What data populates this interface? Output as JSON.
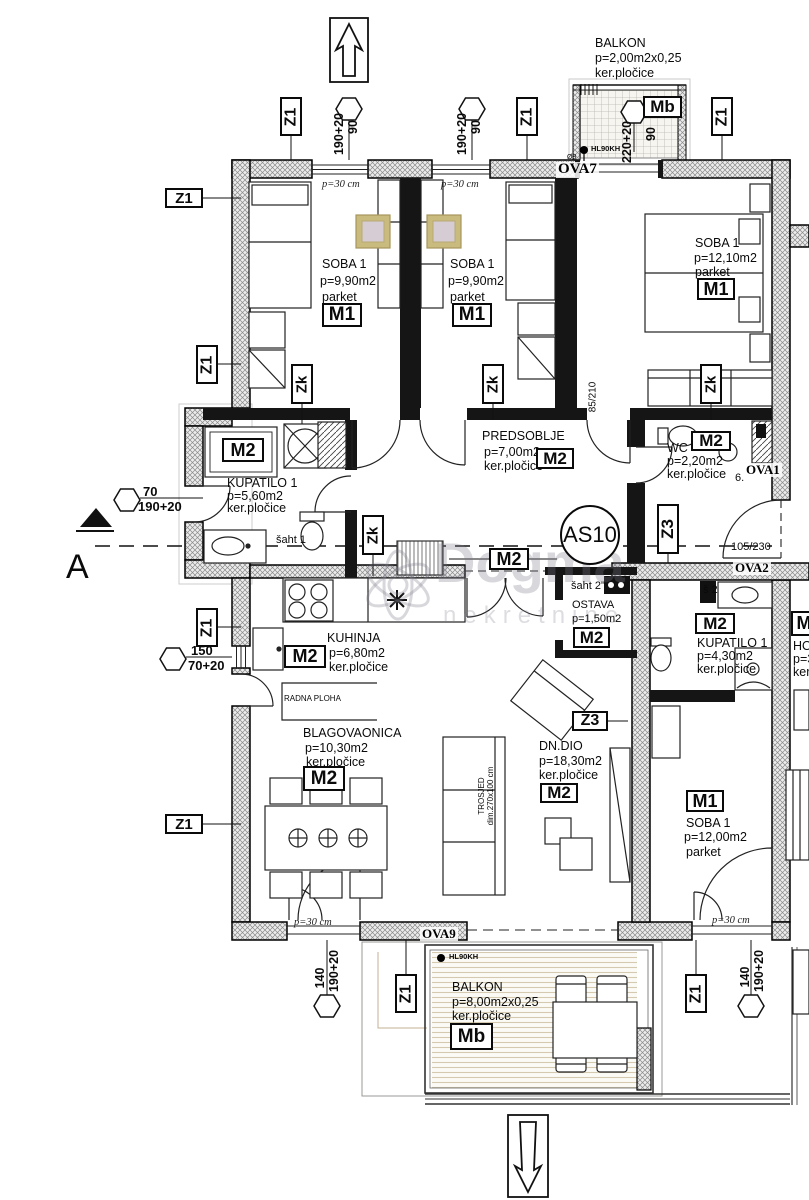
{
  "unit": {
    "code": "AS10"
  },
  "watermark": {
    "line1": "Dogma",
    "line2": "nekretnine"
  },
  "markers": {
    "z1": "Z1",
    "zk": "Zk",
    "z3": "Z3",
    "m2": "M2",
    "section": "A",
    "m_partial": "M"
  },
  "rooms": {
    "soba_tl": {
      "name": "SOBA 1",
      "area": "p=9,90m2",
      "floor": "parket",
      "material": "M1"
    },
    "soba_tc": {
      "name": "SOBA 1",
      "area": "p=9,90m2",
      "floor": "parket",
      "material": "M1"
    },
    "soba_tr": {
      "name": "SOBA 1",
      "area": "p=12,10m2",
      "floor": "parket",
      "material": "M1"
    },
    "predsoblje": {
      "name": "PREDSOBLJE",
      "area": "p=7,00m2",
      "floor": "ker.pločice",
      "material": "M2"
    },
    "wc": {
      "name": "WC",
      "area": "p=2,20m2",
      "floor": "ker.pločice",
      "material": "M2"
    },
    "kupatilo_left": {
      "name": "KUPATILO 1",
      "area": "p=5,60m2",
      "floor": "ker.pločice",
      "material": "M2"
    },
    "kuhinja": {
      "name": "KUHINJA",
      "area": "p=6,80m2",
      "floor": "ker.pločice",
      "material": "M2"
    },
    "blagovaonica": {
      "name": "BLAGOVAONICA",
      "area": "p=10,30m2",
      "floor": "ker.pločice",
      "material": "M2"
    },
    "dn_dio": {
      "name": "DN.DIO",
      "area": "p=18,30m2",
      "floor": "ker.pločice",
      "material": "M2"
    },
    "ostava": {
      "name": "OSTAVA",
      "area": "p=1,50m2",
      "material": "M2"
    },
    "kupatilo_right": {
      "name": "KUPATILO 1",
      "area": "p=4,30m2",
      "floor": "ker.pločice",
      "material": "M2"
    },
    "soba_br": {
      "name": "SOBA 1",
      "area": "p=12,00m2",
      "floor": "parket",
      "material": "M1"
    },
    "balkon_top": {
      "name": "BALKON",
      "area": "p=2,00m2x0,25",
      "floor": "ker.pločice",
      "material": "Mb"
    },
    "balkon_bottom": {
      "name": "BALKON",
      "area": "p=8,00m2x0,25",
      "floor": "ker.pločice",
      "material": "Mb"
    }
  },
  "dims": {
    "win_tl": {
      "a": "190+20",
      "b": "90"
    },
    "win_tc": {
      "a": "190+20",
      "b": "90"
    },
    "balc_door": {
      "a": "220+20",
      "b": "90"
    },
    "bath_door": {
      "a": "70",
      "b": "190+20"
    },
    "kitchen_win": {
      "a": "150",
      "b": "70+20"
    },
    "terrace_door_l": {
      "a": "140",
      "b": "190+20"
    },
    "terrace_door_r": {
      "a": "140",
      "b": "190+20"
    },
    "door105": "105/230",
    "door85": "85/210",
    "p30": "p=30 cm"
  },
  "openings": {
    "ova7": "OVA7",
    "ova1": "OVA1",
    "ova2": "OVA2",
    "ova9": "OVA9",
    "n6": "6.",
    "hl": "HL90KH",
    "fi8": "Ø8"
  },
  "annots": {
    "saht1": "šaht 1",
    "saht2": "šaht 2\"",
    "s2": "š 2",
    "radna": "RADNA PLOHA",
    "trosjed1": "TROSJED",
    "trosjed2": "dim.270x100 cm"
  },
  "neighbor": {
    "ho": "HO",
    "p3": "p=3",
    "ker": "ker"
  },
  "colors": {
    "pillow_accent": "#c9ba7e",
    "balcony_stripe": "#d5cab0",
    "watermark": "#7d7d8c"
  }
}
